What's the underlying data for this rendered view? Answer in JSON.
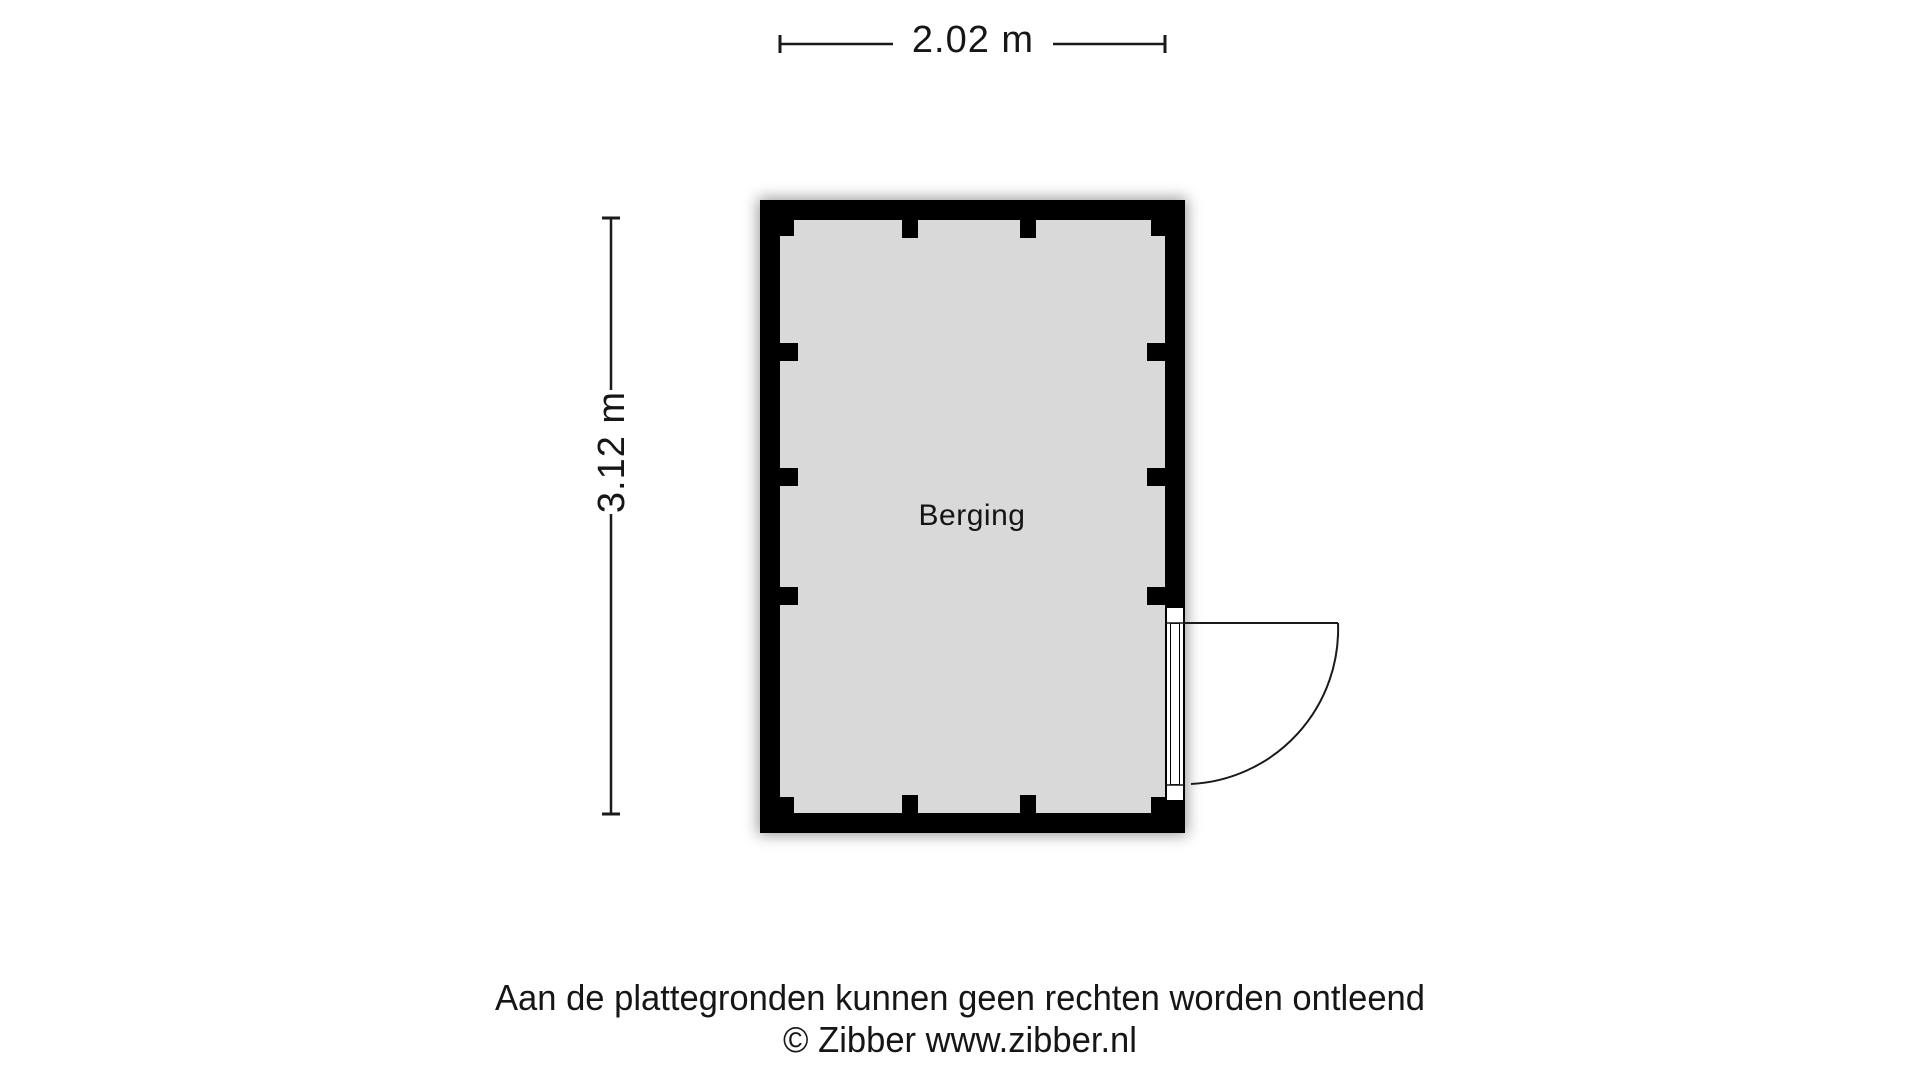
{
  "plan": {
    "room_label": "Berging",
    "width_label": "2.02 m",
    "height_label": "3.12 m"
  },
  "footer": {
    "disclaimer": "Aan de plattegronden kunnen geen rechten worden ontleend",
    "copyright": "© Zibber www.zibber.nl"
  },
  "colors": {
    "wall": "#000000",
    "floor": "#d9d9d9",
    "background": "#ffffff",
    "line": "#1a1a1a",
    "text": "#161616"
  }
}
